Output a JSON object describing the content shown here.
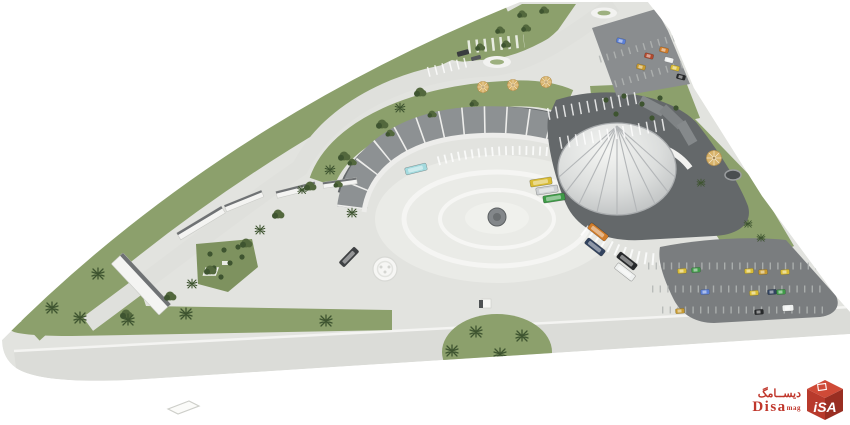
{
  "watermark": {
    "arabic": "ديســامگ",
    "name": "Disa",
    "suffix": "mag",
    "logo_text": "iSA"
  },
  "palette": {
    "bg": "#ffffff",
    "ground": "#e2e3df",
    "band": "#dbdcd8",
    "plaza": "#eaebe7",
    "ring": "#f6f6f4",
    "road": "#dfe0dc",
    "grass": "#8ca06c",
    "grass_dark": "#7e925f",
    "tree": "#53683d",
    "tree_dark": "#3e5430",
    "roof_dark": "#64686a",
    "roof_mid": "#85898b",
    "panel": "#8d9193",
    "panel_sep": "#ededeb",
    "dome_hi": "#f4f5f3",
    "dome_lo": "#b9bcbd",
    "dome_rib": "#b3b6b8",
    "lot": "#7a7d7f",
    "lot_light": "#8a8d8f",
    "stall": "#b2b5b4",
    "red": "#c0372c",
    "red_dark": "#992e22",
    "tan": "#d8b36a"
  },
  "vehicles": {
    "yellow": "#d9bc35",
    "green": "#3f9b48",
    "cyan": "#a3dade",
    "orange": "#d07c2a",
    "navy": "#32435f",
    "black": "#27292b",
    "white": "#eef0ef",
    "blue": "#5b7fd6",
    "gold": "#c79a2f",
    "red": "#b04a2e",
    "gray": "#cdd0d2",
    "dark": "#3e4143"
  },
  "scene": {
    "type": "aerial architectural 3D rendering",
    "elements": [
      "triangular-site",
      "central-circular-plaza",
      "plaza-fountain",
      "domed-terminal-building",
      "curved-canopy",
      "east-parking-lot",
      "north-parking-lot",
      "green-landscaping",
      "palm-trees",
      "parked-buses",
      "parked-cars",
      "roundabout-islands",
      "crosswalk",
      "garden-parasols",
      "pond",
      "retaining-walls",
      "kiosk"
    ]
  }
}
